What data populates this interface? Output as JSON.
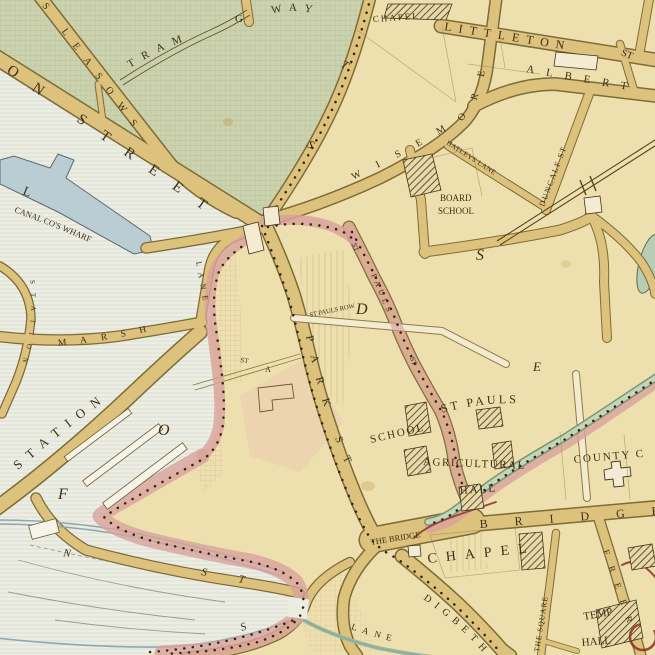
{
  "map_type": "victorian-town-ward-map",
  "colors": {
    "parchment": "#eee0ae",
    "green_area": "#cbd2ad",
    "pale_area": "#edeee3",
    "water": "#b9cdd2",
    "road_fill": "#dcc27c",
    "road_casing": "#7d6b38",
    "boundary_pink": "#d8a29c",
    "brook_green": "#c2d6bc",
    "ink": "#3d2e16",
    "boundary_red": "#9a4535"
  },
  "labels": {
    "tram": "TRAM",
    "way": "WAY",
    "g_letter": "G",
    "leasows": "S LEASOWS",
    "on_street": "ON STREET",
    "dotted_t": "T",
    "dotted_s": "S",
    "littleton": "LITTLETON",
    "littleton_st": "ST",
    "albert": "ALBERT",
    "wisemore": "WISEMORE",
    "duncalf": "DUNCALF ST",
    "hatleys": "HATLEYS LANE",
    "chapel_top": "CHAPEL",
    "board": "BOARD",
    "board_school": "SCHOOL",
    "canal_wharf": "CANAL CO'S WHARF",
    "l_big": "L",
    "marsh": "MARSH",
    "marsh_lane": "LANE",
    "station_small": "STATION",
    "station_big": "STATION",
    "st_small": "ST",
    "a_small": "A",
    "park_st": "PARK ST",
    "st_pauls_row": "ST PAULS ROW",
    "pauls_st_top": "ST",
    "pauls_mid": "PAULS",
    "pauls_st_bot": "ST",
    "st_pauls": "ST PAULS",
    "school": "SCHOOL",
    "agricultural": "AGRICULTURAL",
    "agricultural_hall": "HALL",
    "county": "COUNTY C",
    "the_bridge": "THE BRIDGE",
    "chapel_big": "CHAPEL",
    "bridge_big": "BRIDGE",
    "digbeth": "DIGBETH",
    "the_square": "THE SQUARE",
    "freer": "FREER",
    "temp": "TEMP",
    "temp_hall": "HALL",
    "lane_sw": "LANE",
    "n_letter": "N",
    "s_letter": "S",
    "t_letter": "T",
    "s2_letter": "S",
    "f_big": "F",
    "o_big": "O",
    "d_big": "D",
    "s_big": "S",
    "e_big": "E"
  }
}
